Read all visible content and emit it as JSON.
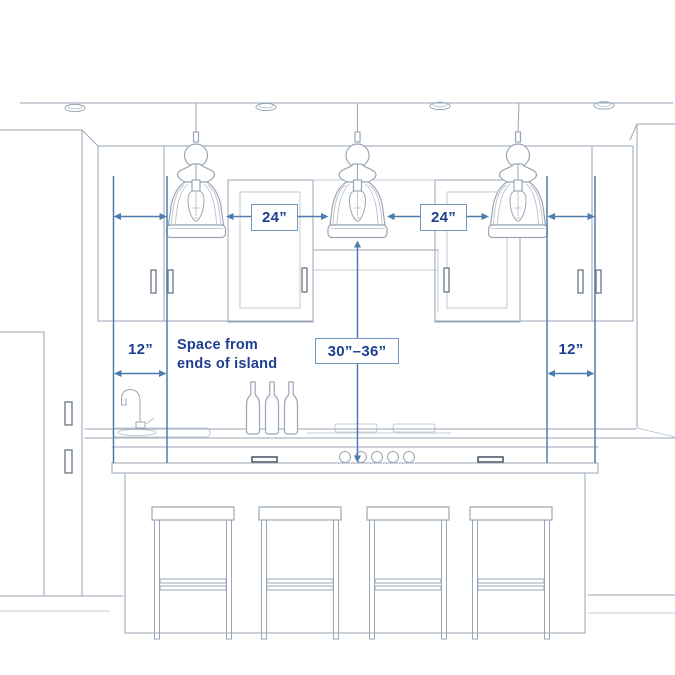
{
  "diagram": {
    "pendant_gap_left": "24”",
    "pendant_gap_right": "24”",
    "pendant_height_range": "30”–36”",
    "island_end_gap_left": "12”",
    "island_end_gap_right": "12”",
    "island_end_note": "Space from\nends of island"
  },
  "colors": {
    "navy-text": "#1e3e90",
    "dimension-blue": "#4e7dad",
    "box-border": "#6f97c0",
    "sketch-line": "#9aa6b5",
    "handle-line": "#6a7686",
    "dark-handle": "#49525f",
    "background": "#ffffff"
  }
}
